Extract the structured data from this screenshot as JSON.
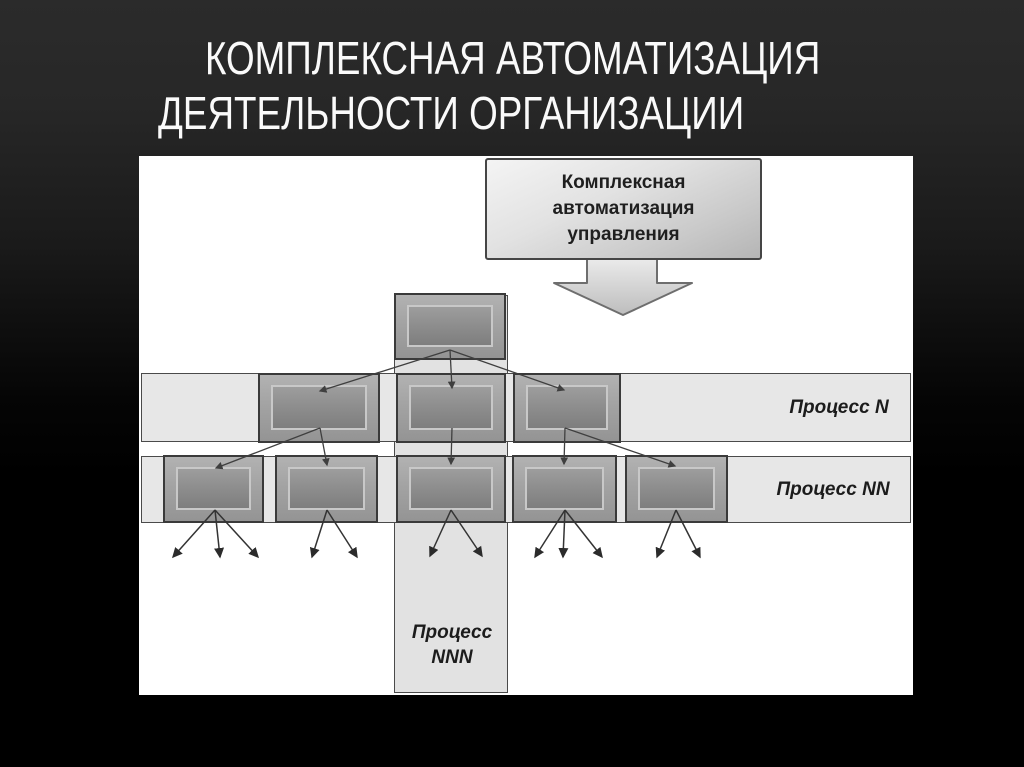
{
  "slide": {
    "title_line1": "КОМПЛЕКСНАЯ АВТОМАТИЗАЦИЯ",
    "title_line2": "ДЕЯТЕЛЬНОСТИ ОРГАНИЗАЦИИ"
  },
  "diagram": {
    "callout_text": "Комплексная автоматизация управления",
    "bands": [
      {
        "label": "Процесс N",
        "orientation": "horizontal",
        "box_count": 3
      },
      {
        "label": "Процесс NN",
        "orientation": "horizontal",
        "box_count": 5
      },
      {
        "label": "Процесс NNN",
        "orientation": "vertical",
        "box_count": 0
      }
    ],
    "hierarchy": {
      "root_boxes": 1,
      "level_n_boxes": 3,
      "level_nn_boxes": 5,
      "level_n_children_per_parent": [
        2,
        1,
        2
      ],
      "leaf_arrow_fanout": [
        3,
        2,
        2,
        3,
        2
      ]
    },
    "colors": {
      "slide_background_top": "#2b2b2b",
      "slide_background_bottom": "#000000",
      "canvas": "#ffffff",
      "band_fill": "#e7e7e7",
      "vertical_band_fill": "#e2e2e2",
      "box_outer_fill": "#a3a3a3",
      "box_inner_fill": "#8d8d8d",
      "callout_fill": "#d9d9d9",
      "connector_color": "#3f3f3f",
      "title_color": "#fafafa"
    }
  }
}
